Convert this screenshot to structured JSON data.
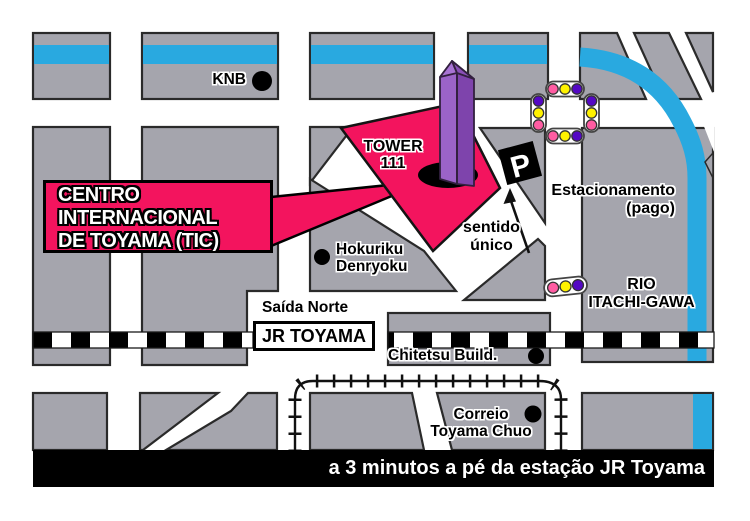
{
  "map": {
    "callout": {
      "line1": "CENTRO",
      "line2": "INTERNACIONAL",
      "line3": "DE TOYAMA (TIC)"
    },
    "labels": {
      "knb": "KNB",
      "tower_1": "TOWER",
      "tower_2": "111",
      "hokuriku_1": "Hokuriku",
      "hokuriku_2": "Denryoku",
      "sentido_1": "sentido",
      "sentido_2": "único",
      "estacionamento_1": "Estacionamento",
      "estacionamento_2": "(pago)",
      "rio_1": "RIO",
      "rio_2": "ITACHI-GAWA",
      "saida_norte": "Saída Norte",
      "jr_toyama": "JR TOYAMA",
      "chitetsu": "Chitetsu Build.",
      "correio_1": "Correio",
      "correio_2": "Toyama Chuo",
      "parking": "P"
    },
    "footer": {
      "text": "a 3 minutos a pé da estação JR Toyama"
    },
    "colors": {
      "block_gray": "#A5A5AD",
      "outline": "#2A2A2A",
      "river_blue": "#29A9E0",
      "tic_pink": "#F3145E",
      "tower_light": "#9B63C8",
      "tower_dark": "#7E44AC",
      "tower_apex_light": "#A873D4",
      "tower_apex_dark": "#8A50B8",
      "signal_pink": "#FF5CA2",
      "signal_yellow": "#FFF200",
      "signal_purple": "#5408C4",
      "footer_black": "#000000"
    }
  }
}
